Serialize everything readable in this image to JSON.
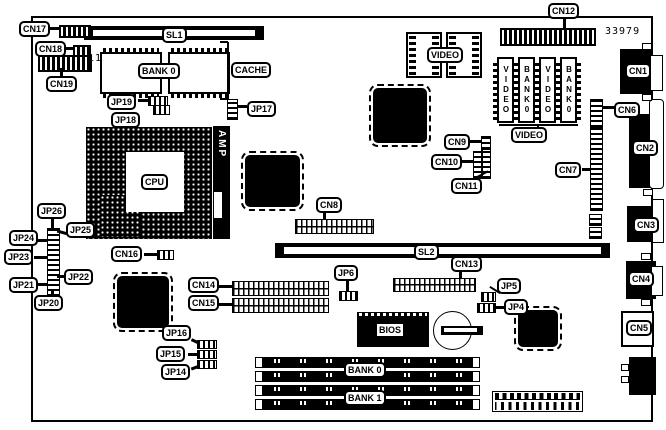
{
  "part_number": "33979",
  "cn19_pin_count": "11",
  "slots": {
    "sl1": "SL1",
    "sl2": "SL2"
  },
  "memory": {
    "cache_bank": "BANK 0",
    "cache": "CACHE",
    "bank0": "BANK 0",
    "bank1": "BANK 1"
  },
  "chips": {
    "cpu": "CPU",
    "amp": "AMP",
    "bios": "BIOS"
  },
  "video": {
    "dip_label": "VIDEO",
    "group_label": "VIDEO",
    "chips": [
      "VIDEO",
      "BANK0",
      "VIDEO",
      "BANK0"
    ]
  },
  "connectors": {
    "cn1": "CN1",
    "cn2": "CN2",
    "cn3": "CN3",
    "cn4": "CN4",
    "cn5": "CN5",
    "cn6": "CN6",
    "cn7": "CN7",
    "cn8": "CN8",
    "cn9": "CN9",
    "cn10": "CN10",
    "cn11": "CN11",
    "cn12": "CN12",
    "cn13": "CN13",
    "cn14": "CN14",
    "cn15": "CN15",
    "cn16": "CN16",
    "cn17": "CN17",
    "cn18": "CN18",
    "cn19": "CN19"
  },
  "jumpers": {
    "jp4": "JP4",
    "jp5": "JP5",
    "jp6": "JP6",
    "jp14": "JP14",
    "jp15": "JP15",
    "jp16": "JP16",
    "jp17": "JP17",
    "jp18": "JP18",
    "jp19": "JP19",
    "jp20": "JP20",
    "jp21": "JP21",
    "jp22": "JP22",
    "jp23": "JP23",
    "jp24": "JP24",
    "jp25": "JP25",
    "jp26": "JP26"
  },
  "colors": {
    "ink": "#000000",
    "paper": "#ffffff"
  }
}
